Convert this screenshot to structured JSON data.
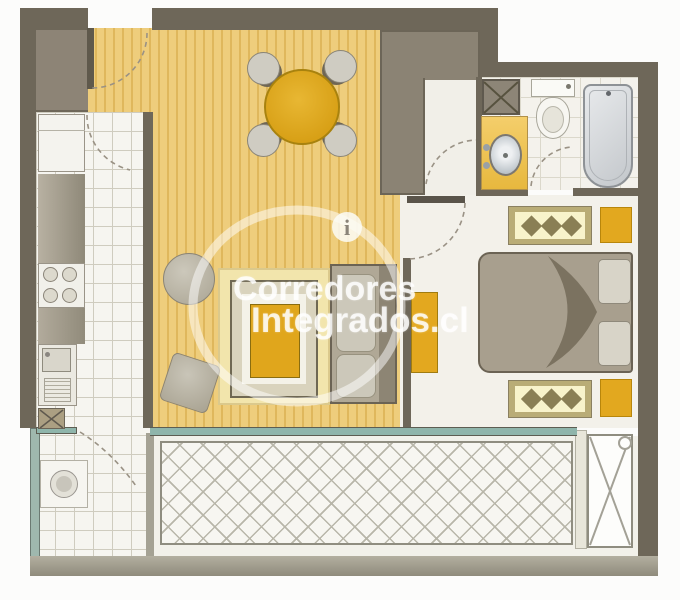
{
  "watermark": {
    "logo_letter": "i",
    "line1": "Corredores",
    "line2": "Integrados.cl"
  },
  "palette": {
    "wall": "#6e6759",
    "closet_block": "#8b8374",
    "wood_floor": "#eecd7c",
    "wood_floor_stripe": "#dfb75c",
    "tile_floor": "#f6f5f0",
    "bedroom_floor": "#f3f1ea",
    "balcony_floor": "#f2f1ea",
    "accent_yellow": "#e0a61c",
    "table_gold": "#d79f15",
    "rug": "#f2e5ac",
    "glass_teal": "#8fb5ab",
    "furniture_gray": "#a89f8e",
    "watermark_white": "rgba(255,255,255,0.82)"
  },
  "fixtures": [
    "entry-door",
    "entry-closet",
    "refrigerator",
    "kitchen-counter",
    "stove-burners",
    "kitchen-sink",
    "dish-rack",
    "cabinet-x",
    "washing-machine",
    "dining-table",
    "dining-chair",
    "area-rug",
    "coffee-table",
    "sofa",
    "round-pouf",
    "square-pouf",
    "desk",
    "double-bed",
    "pillow",
    "dresser-diamonds",
    "nightstand",
    "vanity-sink",
    "toilet",
    "bathtub",
    "duct-shaft",
    "balcony-lattice",
    "balcony-unit"
  ]
}
